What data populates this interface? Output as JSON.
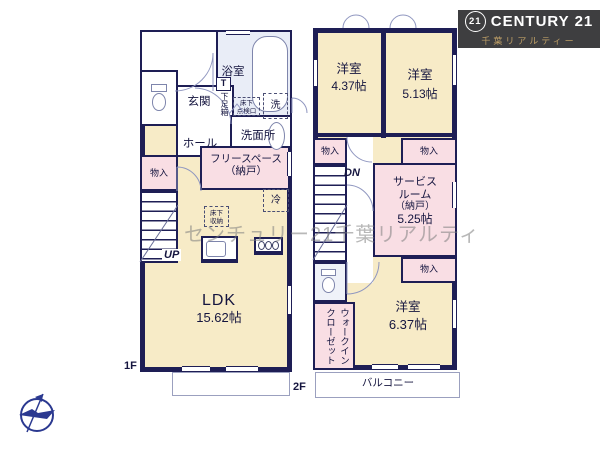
{
  "logo": {
    "symbol": "21",
    "brand": "CENTURY 21",
    "subtitle": "千葉リアルティー"
  },
  "watermark": "センチュリー21千葉リアルティ",
  "colors": {
    "wall": "#1E1E55",
    "room_cream": "#F7EBC7",
    "room_pink": "#F9DEE4",
    "bath_blue": "#E9EDF7",
    "logo_bg": "#3E3E40",
    "logo_gold": "#BD9E66",
    "compass_blue": "#2B3990"
  },
  "floor1": {
    "label": "1F",
    "bath": "浴室",
    "laundry": "洗",
    "washroom": "洗面所",
    "inspection_line1": "床下",
    "inspection_line2": "点検口",
    "shoe_box_t": "T",
    "shoe_box": "下足箱",
    "entrance": "玄関",
    "hall": "ホール",
    "closet": "物入",
    "free_space_line1": "フリースペース",
    "free_space_line2": "（納戸）",
    "fridge": "冷",
    "underfloor_line1": "床下",
    "underfloor_line2": "収納",
    "stairs_up": "UP",
    "ldk_name": "LDK",
    "ldk_size": "15.62帖"
  },
  "floor2": {
    "label": "2F",
    "bedroom1_name": "洋室",
    "bedroom1_size": "4.37帖",
    "bedroom2_name": "洋室",
    "bedroom2_size": "5.13帖",
    "closet_left": "物入",
    "closet_top_right": "物入",
    "closet_bottom": "物入",
    "stairs_down": "DN",
    "service_line1": "サービス",
    "service_line2": "ルーム",
    "service_line3": "（納戸）",
    "service_line4": "5.25帖",
    "walk_in_closet": "ウォークインクローゼット",
    "bedroom3_name": "洋室",
    "bedroom3_size": "6.37帖",
    "balcony": "バルコニー"
  }
}
